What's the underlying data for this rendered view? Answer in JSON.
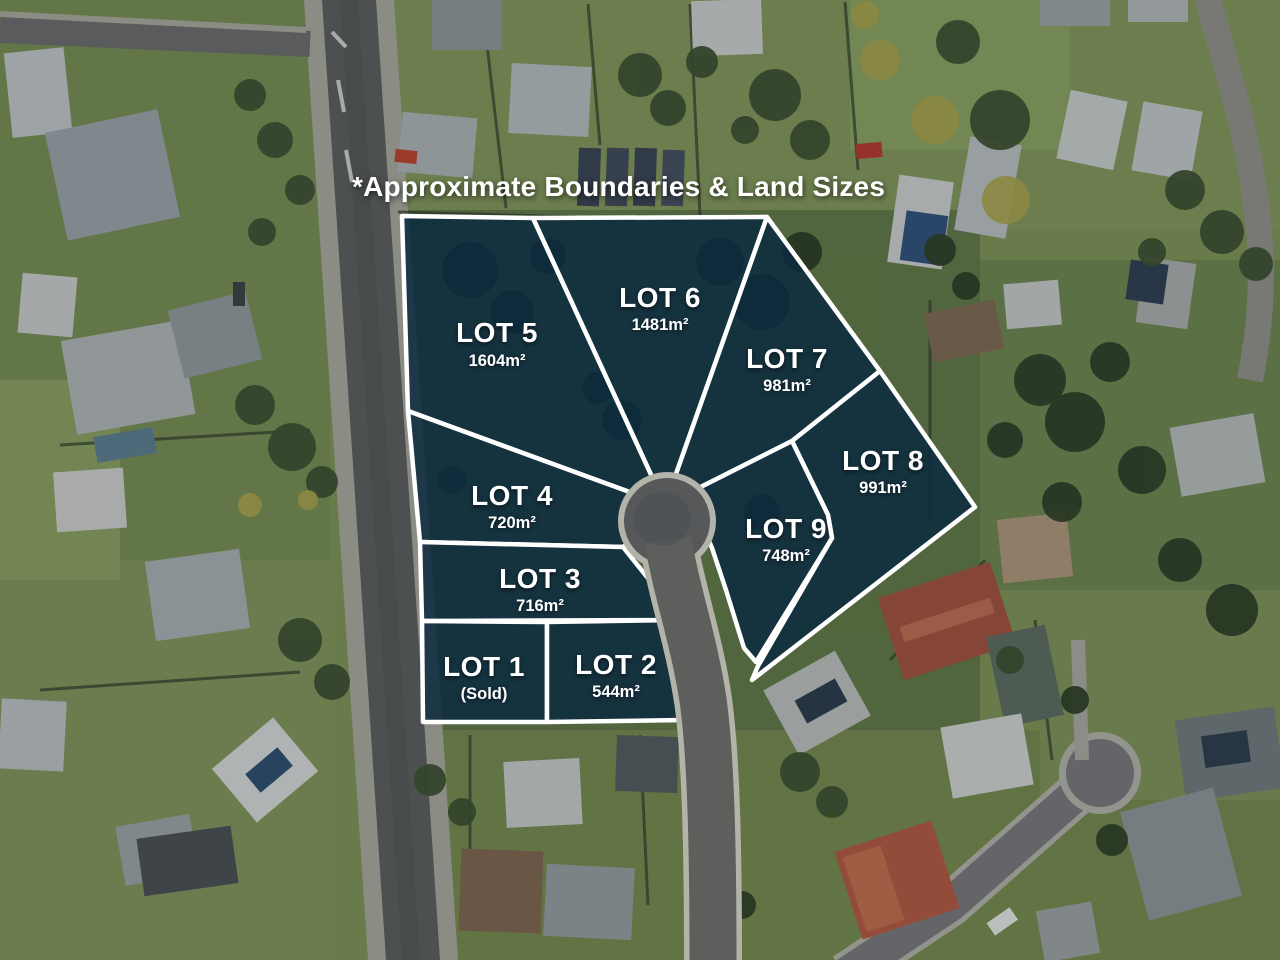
{
  "title": "*Approximate Boundaries & Land Sizes",
  "colors": {
    "overlay_fill": "rgba(11,41,64,0.85)",
    "boundary": "#ffffff",
    "label_text": "#ffffff"
  },
  "lots": [
    {
      "id": "lot-1",
      "label": "LOT 1",
      "area": "(Sold)"
    },
    {
      "id": "lot-2",
      "label": "LOT 2",
      "area": "544m²"
    },
    {
      "id": "lot-3",
      "label": "LOT 3",
      "area": "716m²"
    },
    {
      "id": "lot-4",
      "label": "LOT 4",
      "area": "720m²"
    },
    {
      "id": "lot-5",
      "label": "LOT 5",
      "area": "1604m²"
    },
    {
      "id": "lot-6",
      "label": "LOT 6",
      "area": "1481m²"
    },
    {
      "id": "lot-7",
      "label": "LOT 7",
      "area": "981m²"
    },
    {
      "id": "lot-8",
      "label": "LOT 8",
      "area": "991m²"
    },
    {
      "id": "lot-9",
      "label": "LOT 9",
      "area": "748m²"
    }
  ]
}
